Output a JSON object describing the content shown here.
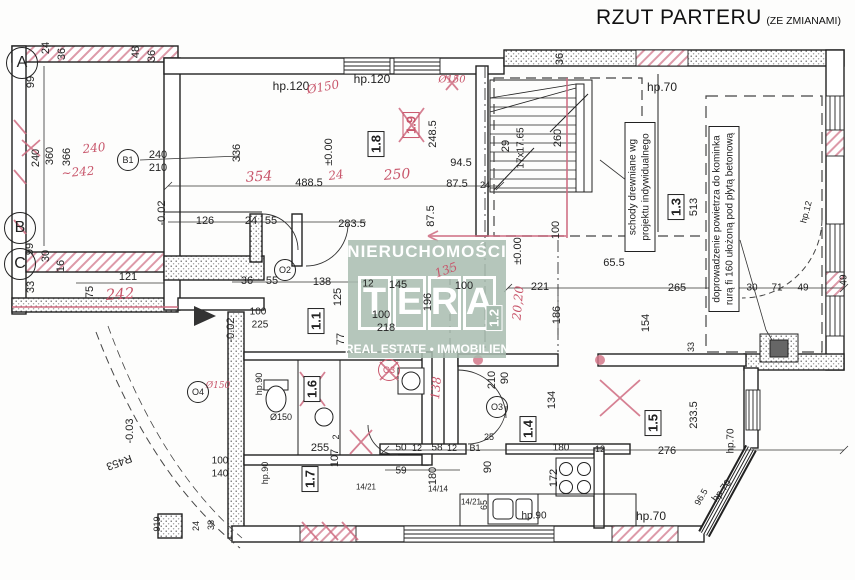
{
  "title": {
    "main": "RZUT PARTERU",
    "suffix": "(ZE ZMIANAMI)"
  },
  "watermark": {
    "top": "NIERUCHOMOŚCI",
    "brand": [
      "T",
      "E",
      "R",
      "A"
    ],
    "bottom": "REAL ESTATE • IMMOBILIEN",
    "color": "#a8bdb0"
  },
  "notes": [
    {
      "id": "stairs-note",
      "text": "schody drewniane wg projektu indywidualnego"
    },
    {
      "id": "air-note",
      "text": "doprowadzenie powietrza do kominka rurą fi 160 ułożoną pod płytą betonową"
    }
  ],
  "colors": {
    "annotation_red": "#c8566b",
    "watermark_green": "#a8bdb0",
    "line": "#222222"
  },
  "plan": {
    "rooms": [
      {
        "id": "1.1",
        "x": 316,
        "y": 321
      },
      {
        "id": "1.2",
        "x": 494,
        "y": 318,
        "variant": "wm"
      },
      {
        "id": "1.3",
        "x": 676,
        "y": 207
      },
      {
        "id": "1.4",
        "x": 528,
        "y": 429
      },
      {
        "id": "1.5",
        "x": 653,
        "y": 423
      },
      {
        "id": "1.6",
        "x": 312,
        "y": 389
      },
      {
        "id": "1.7",
        "x": 310,
        "y": 479
      },
      {
        "id": "1.8",
        "x": 376,
        "y": 144
      },
      {
        "id": "1.9",
        "x": 411,
        "y": 125,
        "variant": "red"
      }
    ],
    "axes": [
      {
        "id": "A",
        "x": 22,
        "y": 63
      },
      {
        "id": "B",
        "x": 20,
        "y": 228
      },
      {
        "id": "C",
        "x": 20,
        "y": 264
      }
    ],
    "symbols": [
      {
        "id": "B1",
        "x": 128,
        "y": 160
      },
      {
        "id": "O2",
        "x": 285,
        "y": 270
      },
      {
        "id": "O3",
        "x": 497,
        "y": 407
      },
      {
        "id": "O4",
        "x": 198,
        "y": 392
      },
      {
        "id": "O3",
        "x": 389,
        "y": 370,
        "variant": "red"
      }
    ],
    "labels": [
      {
        "t": "24",
        "x": 46,
        "y": 48,
        "r": -90
      },
      {
        "t": "36",
        "x": 62,
        "y": 54,
        "r": -90
      },
      {
        "t": "48",
        "x": 136,
        "y": 52,
        "r": -90
      },
      {
        "t": "36",
        "x": 152,
        "y": 56,
        "r": -90
      },
      {
        "t": "99",
        "x": 31,
        "y": 82,
        "r": -90
      },
      {
        "t": "240",
        "x": 36,
        "y": 158,
        "r": -90
      },
      {
        "t": "360",
        "x": 50,
        "y": 156,
        "r": -90
      },
      {
        "t": "366",
        "x": 67,
        "y": 157,
        "r": -90
      },
      {
        "t": "240",
        "x": 94,
        "y": 148,
        "c": "red",
        "r": -6
      },
      {
        "t": "~242",
        "x": 78,
        "y": 172,
        "c": "red",
        "r": -5
      },
      {
        "t": "240",
        "x": 158,
        "y": 155
      },
      {
        "t": "210",
        "x": 158,
        "y": 168
      },
      {
        "t": "-0.02",
        "x": 162,
        "y": 213,
        "r": -90
      },
      {
        "t": "126",
        "x": 205,
        "y": 221
      },
      {
        "t": "24",
        "x": 251,
        "y": 221
      },
      {
        "t": "55",
        "x": 271,
        "y": 221
      },
      {
        "t": "283.5",
        "x": 352,
        "y": 224
      },
      {
        "t": "36",
        "x": 247,
        "y": 281
      },
      {
        "t": "55",
        "x": 272,
        "y": 281
      },
      {
        "t": "138",
        "x": 322,
        "y": 282
      },
      {
        "t": "125",
        "x": 338,
        "y": 297,
        "r": -90
      },
      {
        "t": "121",
        "x": 128,
        "y": 277
      },
      {
        "t": "75",
        "x": 90,
        "y": 292,
        "r": -90
      },
      {
        "t": "242",
        "x": 120,
        "y": 294,
        "c": "red",
        "s": 15,
        "r": -4
      },
      {
        "t": "99",
        "x": 30,
        "y": 249,
        "r": -90
      },
      {
        "t": "30",
        "x": 46,
        "y": 256,
        "r": -90
      },
      {
        "t": "16",
        "x": 61,
        "y": 266,
        "r": -90
      },
      {
        "t": "33",
        "x": 31,
        "y": 287,
        "r": -90
      },
      {
        "t": "hp.120",
        "x": 291,
        "y": 86,
        "s": 12
      },
      {
        "t": "hp.120",
        "x": 372,
        "y": 79,
        "s": 12
      },
      {
        "t": "Ø150",
        "x": 323,
        "y": 87,
        "c": "red",
        "r": -10
      },
      {
        "t": "Ø150",
        "x": 452,
        "y": 80,
        "c": "red",
        "s": 10
      },
      {
        "t": "336",
        "x": 237,
        "y": 153,
        "r": -90
      },
      {
        "t": "354",
        "x": 259,
        "y": 177,
        "c": "red",
        "s": 14,
        "r": -3
      },
      {
        "t": "488.5",
        "x": 309,
        "y": 183
      },
      {
        "t": "24",
        "x": 336,
        "y": 175,
        "c": "red",
        "r": -8
      },
      {
        "t": "±0.00",
        "x": 329,
        "y": 152,
        "r": -90
      },
      {
        "t": "248.5",
        "x": 433,
        "y": 134,
        "r": -90
      },
      {
        "t": "94.5",
        "x": 461,
        "y": 163
      },
      {
        "t": "87.5",
        "x": 457,
        "y": 184
      },
      {
        "t": "24",
        "x": 485,
        "y": 185,
        "s": 9
      },
      {
        "t": "250",
        "x": 397,
        "y": 175,
        "c": "red",
        "s": 14,
        "r": -4
      },
      {
        "t": "87.5",
        "x": 431,
        "y": 216,
        "r": -90
      },
      {
        "t": "17x17.65",
        "x": 521,
        "y": 148,
        "r": -90,
        "s": 10
      },
      {
        "t": "29",
        "x": 506,
        "y": 146,
        "r": -90
      },
      {
        "t": "260",
        "x": 558,
        "y": 138,
        "r": -90
      },
      {
        "t": "36",
        "x": 560,
        "y": 59,
        "r": -90
      },
      {
        "t": "100",
        "x": 556,
        "y": 230,
        "r": -90
      },
      {
        "t": "±0.00",
        "x": 518,
        "y": 251,
        "r": -90
      },
      {
        "t": "hp.70",
        "x": 662,
        "y": 87,
        "s": 12
      },
      {
        "t": "513",
        "x": 694,
        "y": 207,
        "r": -90
      },
      {
        "t": "hp.12",
        "x": 806,
        "y": 212,
        "r": -75,
        "s": 9
      },
      {
        "t": "30",
        "x": 752,
        "y": 288,
        "s": 10
      },
      {
        "t": "71",
        "x": 777,
        "y": 288,
        "s": 10
      },
      {
        "t": "49",
        "x": 803,
        "y": 288,
        "s": 10
      },
      {
        "t": "49",
        "x": 844,
        "y": 280,
        "r": -90,
        "s": 10
      },
      {
        "t": "221",
        "x": 540,
        "y": 287
      },
      {
        "t": "65.5",
        "x": 614,
        "y": 263
      },
      {
        "t": "265",
        "x": 677,
        "y": 288
      },
      {
        "t": "186",
        "x": 557,
        "y": 315,
        "r": -90
      },
      {
        "t": "154",
        "x": 646,
        "y": 323,
        "r": -90
      },
      {
        "t": "33",
        "x": 691,
        "y": 347,
        "r": -90,
        "s": 9
      },
      {
        "t": "20,20",
        "x": 518,
        "y": 303,
        "c": "red",
        "r": -85
      },
      {
        "t": "12",
        "x": 368,
        "y": 284,
        "s": 10
      },
      {
        "t": "145",
        "x": 398,
        "y": 285
      },
      {
        "t": "100",
        "x": 464,
        "y": 286
      },
      {
        "t": "135",
        "x": 446,
        "y": 270,
        "c": "red",
        "r": -20
      },
      {
        "t": "196",
        "x": 428,
        "y": 302,
        "r": -90
      },
      {
        "t": "100",
        "x": 381,
        "y": 315
      },
      {
        "t": "218",
        "x": 386,
        "y": 328
      },
      {
        "t": "77",
        "x": 341,
        "y": 339,
        "r": -90
      },
      {
        "t": "100",
        "x": 258,
        "y": 312,
        "s": 10
      },
      {
        "t": "225",
        "x": 260,
        "y": 325,
        "s": 10
      },
      {
        "t": "-0.02",
        "x": 231,
        "y": 330,
        "r": -90
      },
      {
        "t": "Ø150",
        "x": 218,
        "y": 386,
        "c": "red",
        "s": 9
      },
      {
        "t": "Ø150",
        "x": 281,
        "y": 417,
        "s": 9
      },
      {
        "t": "hp.90",
        "x": 259,
        "y": 384,
        "r": -90,
        "s": 9
      },
      {
        "t": "255",
        "x": 320,
        "y": 448
      },
      {
        "t": "2",
        "x": 336,
        "y": 437,
        "r": -90,
        "s": 9
      },
      {
        "t": "107",
        "x": 335,
        "y": 458,
        "r": -90
      },
      {
        "t": "138",
        "x": 436,
        "y": 388,
        "c": "red",
        "r": -85
      },
      {
        "t": "R453",
        "x": 119,
        "y": 462,
        "r": 160
      },
      {
        "t": "-0.03",
        "x": 130,
        "y": 431,
        "r": -90
      },
      {
        "t": "100",
        "x": 220,
        "y": 461,
        "s": 10
      },
      {
        "t": "140",
        "x": 220,
        "y": 474,
        "s": 10
      },
      {
        "t": "hp.90",
        "x": 265,
        "y": 473,
        "r": -90,
        "s": 9
      },
      {
        "t": "24",
        "x": 196,
        "y": 526,
        "r": -90,
        "s": 9
      },
      {
        "t": "38",
        "x": 211,
        "y": 525,
        "r": -90,
        "s": 9
      },
      {
        "t": "919",
        "x": 157,
        "y": 524,
        "r": -90,
        "s": 9
      },
      {
        "t": "50",
        "x": 401,
        "y": 448,
        "s": 10
      },
      {
        "t": "12",
        "x": 417,
        "y": 448,
        "s": 9
      },
      {
        "t": "58",
        "x": 437,
        "y": 448,
        "s": 10
      },
      {
        "t": "12",
        "x": 452,
        "y": 448,
        "s": 9
      },
      {
        "t": "B1",
        "x": 475,
        "y": 448,
        "s": 9
      },
      {
        "t": "59",
        "x": 401,
        "y": 471,
        "s": 10
      },
      {
        "t": "180",
        "x": 433,
        "y": 476,
        "r": -90
      },
      {
        "t": "14/14",
        "x": 438,
        "y": 489,
        "s": 8
      },
      {
        "t": "14/21",
        "x": 366,
        "y": 487,
        "s": 8
      },
      {
        "t": "14/21",
        "x": 471,
        "y": 502,
        "s": 8
      },
      {
        "t": "65",
        "x": 484,
        "y": 505,
        "r": -90,
        "s": 9
      },
      {
        "t": "90",
        "x": 488,
        "y": 467,
        "r": -90
      },
      {
        "t": "hp.90",
        "x": 534,
        "y": 516,
        "s": 10
      },
      {
        "t": "172",
        "x": 554,
        "y": 478,
        "r": -90
      },
      {
        "t": "180",
        "x": 561,
        "y": 448,
        "s": 10
      },
      {
        "t": "12",
        "x": 600,
        "y": 449,
        "s": 9
      },
      {
        "t": "276",
        "x": 667,
        "y": 451
      },
      {
        "t": "90",
        "x": 505,
        "y": 378,
        "r": -90
      },
      {
        "t": "210",
        "x": 492,
        "y": 380,
        "r": -90
      },
      {
        "t": "25",
        "x": 489,
        "y": 437,
        "s": 9
      },
      {
        "t": "134",
        "x": 552,
        "y": 400,
        "r": -90
      },
      {
        "t": "233.5",
        "x": 694,
        "y": 415,
        "r": -90
      },
      {
        "t": "hp.70",
        "x": 731,
        "y": 441,
        "r": -90,
        "s": 10
      },
      {
        "t": "hp.70",
        "x": 651,
        "y": 516,
        "s": 12
      },
      {
        "t": "hp.70",
        "x": 722,
        "y": 491,
        "r": -52,
        "s": 10
      },
      {
        "t": "96.5",
        "x": 701,
        "y": 497,
        "r": -60,
        "s": 9
      }
    ]
  }
}
